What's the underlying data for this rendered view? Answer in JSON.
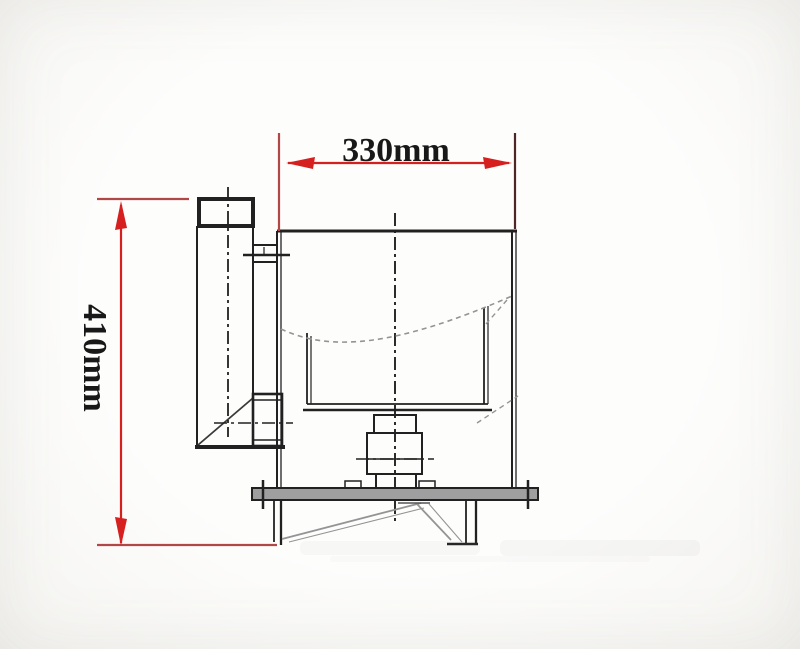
{
  "drawing": {
    "title": "machine-side-view-dimension-drawing",
    "width_dimension_label": "330mm",
    "height_dimension_label": "410mm"
  },
  "colors": {
    "dimension_red": "#d61f1f",
    "extension_red": "#b04848",
    "extension_dark": "#4f2626",
    "line_black": "#212121",
    "hidden_gray": "#949494",
    "plate_gray": "#9f9f9f",
    "background": "#fcfcfb"
  }
}
